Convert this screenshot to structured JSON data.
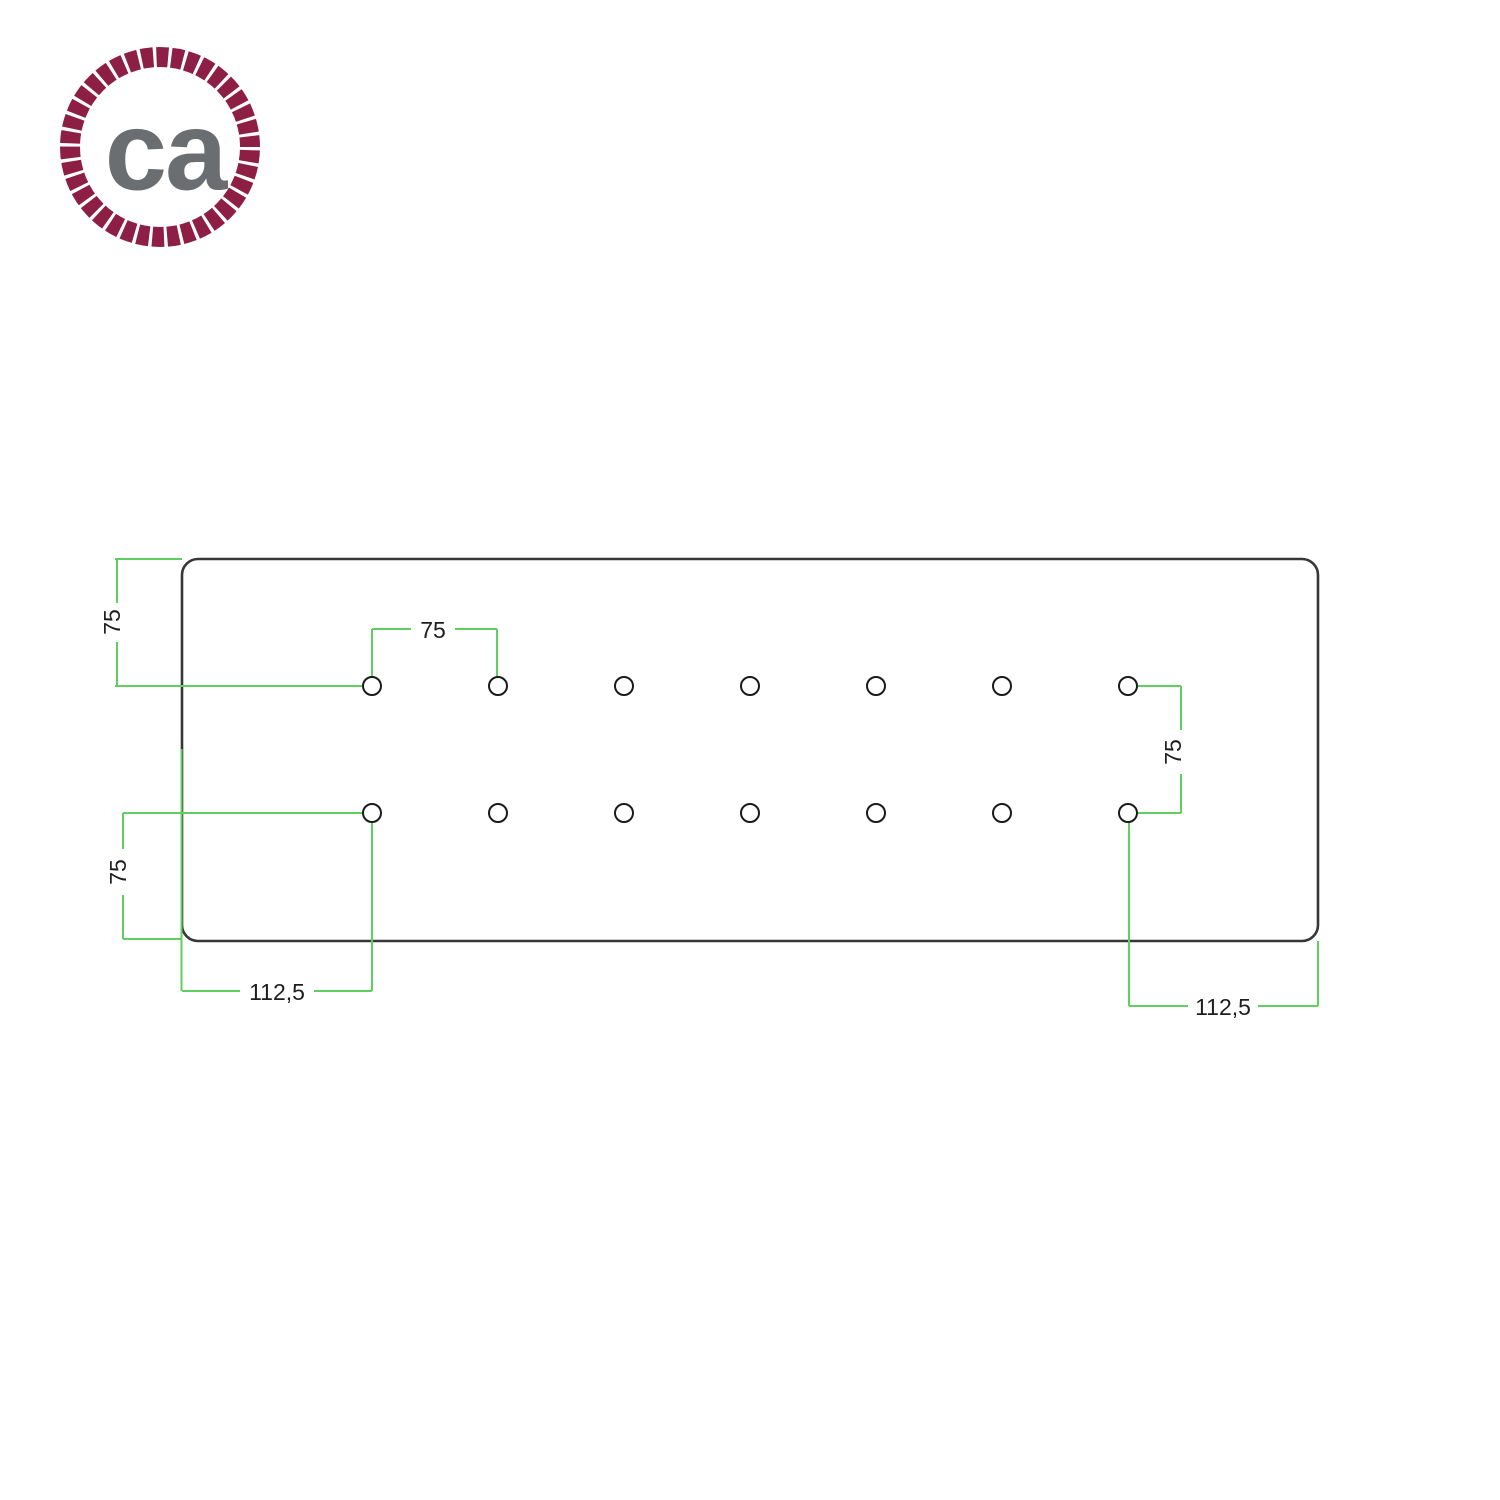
{
  "brand": {
    "logo_text": "ca"
  },
  "drawing": {
    "dimensions": {
      "top_left_vertical": "75",
      "top_hole_spacing": "75",
      "right_row_spacing": "75",
      "bottom_left_vertical": "75",
      "bottom_left_horizontal": "112,5",
      "bottom_right_horizontal": "112,5"
    },
    "holes": {
      "rows": 2,
      "per_row": 7,
      "total": 14
    }
  },
  "colors": {
    "dimension-line": "#5fcf5f",
    "dimension-text": "#1e1e1e",
    "plate-outline": "#373737",
    "hole-outline": "#1a1a1a",
    "logo-rope": "#8e1f44",
    "logo-text": "#6b6e70",
    "background": "#ffffff"
  }
}
